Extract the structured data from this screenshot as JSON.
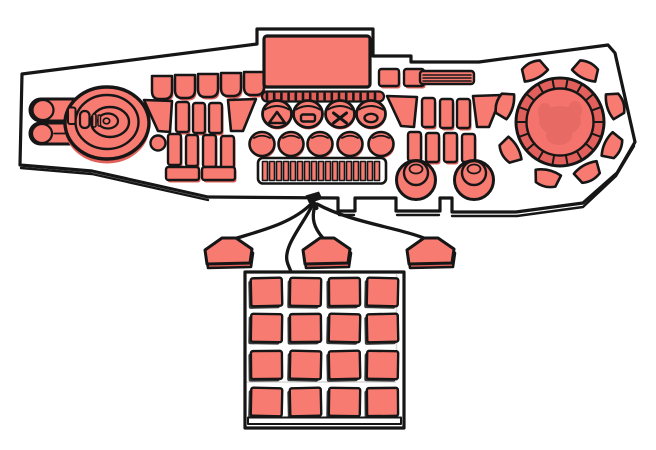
{
  "device": {
    "name": "hand-drawn illustration of a music production controller with foot pedals and drum pad grid",
    "colors": {
      "fill": "#f87b72",
      "fill_dark": "#e2605a",
      "dial_ring": "#e2605b",
      "dial_disc": "#f5736d",
      "outline": "#161616",
      "background": "#ffffff",
      "seam": "#d8d8d8"
    },
    "console": {
      "display": "screen",
      "key_buttons_count": 5,
      "tick_strip_dashes": 16,
      "transport_symbols": [
        "triangle",
        "dash",
        "cross",
        "circle"
      ],
      "knob_row_count": 5,
      "step_strip_cells": 17,
      "dome_knobs_count": 2,
      "rotary_dial": {
        "ray_buttons": 8,
        "ring_segments": 18
      },
      "jog_wheel": "concentric platter with side buttons",
      "left_slider_pills": 2
    },
    "pedals": {
      "count": 3
    },
    "pad_grid": {
      "rows": 4,
      "cols": 4,
      "count": 16
    }
  }
}
